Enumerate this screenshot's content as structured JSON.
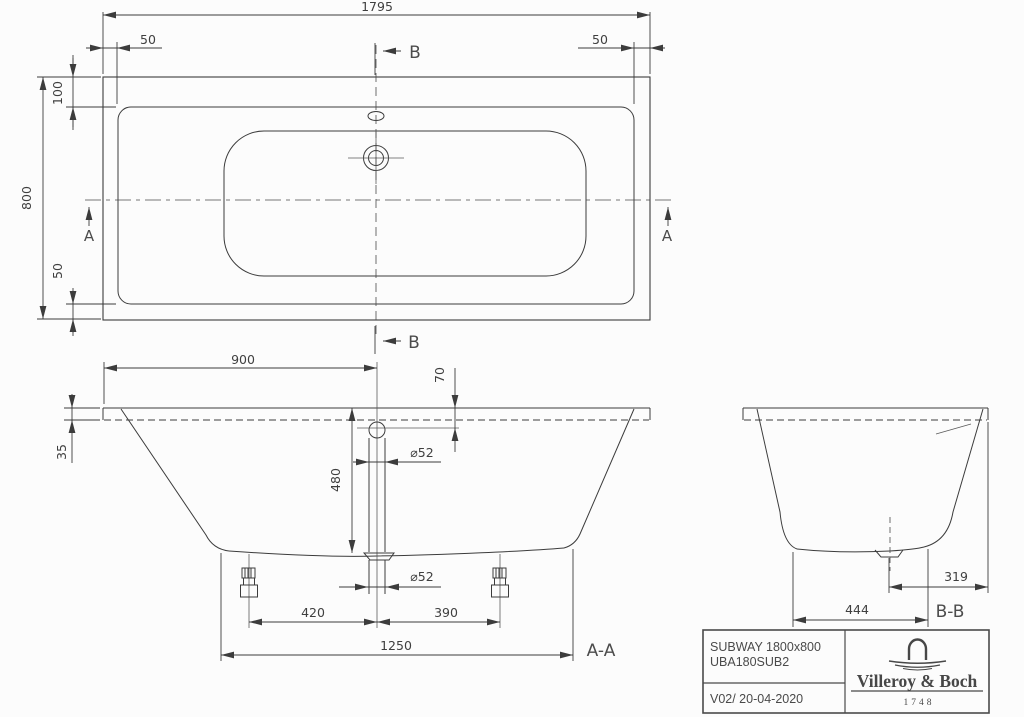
{
  "colors": {
    "background": "#fcfcfc",
    "line": "#3c3c3c",
    "text": "#3f3f3f"
  },
  "top_view": {
    "dim_overall_length": "1795",
    "dim_left_inset": "50",
    "dim_right_inset": "50",
    "dim_top_inset": "100",
    "dim_overall_width": "800",
    "dim_bottom_inset": "50",
    "marker_a": "A",
    "marker_b": "B"
  },
  "section_aa": {
    "label": "A-A",
    "dim_drain_center_from_left": "900",
    "dim_overflow_below_rim": "70",
    "dim_rim_edge_height": "35",
    "dim_inner_depth": "480",
    "dim_overflow_diameter": "⌀52",
    "dim_drain_diameter": "⌀52",
    "dim_left_foot_to_drain": "420",
    "dim_drain_to_right_foot": "390",
    "dim_base_length": "1250"
  },
  "section_bb": {
    "label": "B-B",
    "dim_base_width": "444",
    "dim_drain_center_to_edge": "319"
  },
  "title_block": {
    "product_name": "SUBWAY 1800x800",
    "article_number": "UBA180SUB2",
    "revision_date": "V02/ 20-04-2020",
    "brand_name": "Villeroy & Boch",
    "brand_founding_year": "1748"
  }
}
